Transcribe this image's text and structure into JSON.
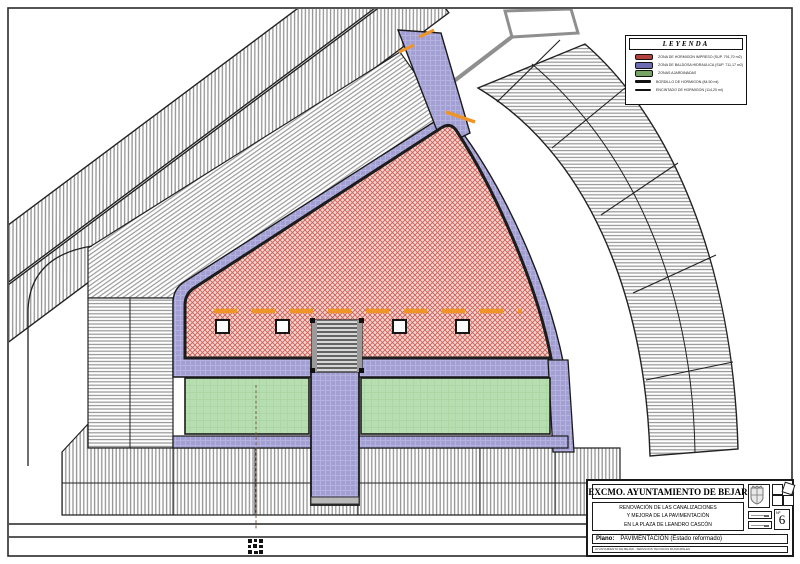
{
  "page": {
    "description": "Plan drawing - pavement renovation of Plaza de Leandro Cascon, Bejar",
    "frame_color": "#2a2a2a",
    "background": "#ffffff"
  },
  "colors": {
    "printed_concrete_pink": "#f5d5d0",
    "printed_concrete_hatch": "#cb6058",
    "tile_paving_purple": "#a29fd3",
    "garden_green": "#b7deb0",
    "orange_marking": "#ef9426",
    "building_hatch_gray": "#949494",
    "wall_gray": "#8f8f8f",
    "legend_red_swatch": "#b5413f",
    "legend_blue_swatch": "#6e6bb5",
    "legend_green_swatch": "#76a465"
  },
  "legend": {
    "title": "LEYENDA",
    "items": [
      {
        "swatch": "#b5413f",
        "type": "area",
        "label": "ZONA DE HORMIGON IMPRESO (SUP. 791,70 m2)"
      },
      {
        "swatch": "#6e6bb5",
        "type": "area",
        "label": "ZONA DE BALDOSA HIDRAULICA (SUP. 711,17 m2)"
      },
      {
        "swatch": "#76a465",
        "type": "area",
        "label": "ZONAS AJARDINADAS"
      },
      {
        "swatch": "#111111",
        "type": "line",
        "label": "BORDILLO DE HORMIGON (84,50 ml)"
      },
      {
        "swatch": "#111111",
        "type": "line",
        "label": "ENCINTADO DE HORMIGON (114,20 ml)"
      }
    ]
  },
  "title_block": {
    "organization": "EXCMO. AYUNTAMIENTO DE BEJAR",
    "project_lines": [
      "RENOVACIÓN DE LAS CANALIZACIONES",
      "Y MEJORA DE LA PAVIMENTACIÓN",
      "EN LA PLAZA DE LEANDRO CASCÓN"
    ],
    "plan_label": "Plano:",
    "plan_name": "PAVIMENTACIÓN (Estado reformado)",
    "sheet_label": "Nº",
    "sheet_number": "6",
    "footer": "AYUNTAMIENTO DE BEJAR  -  SERVICIOS TECNICOS MUNICIPALES"
  }
}
